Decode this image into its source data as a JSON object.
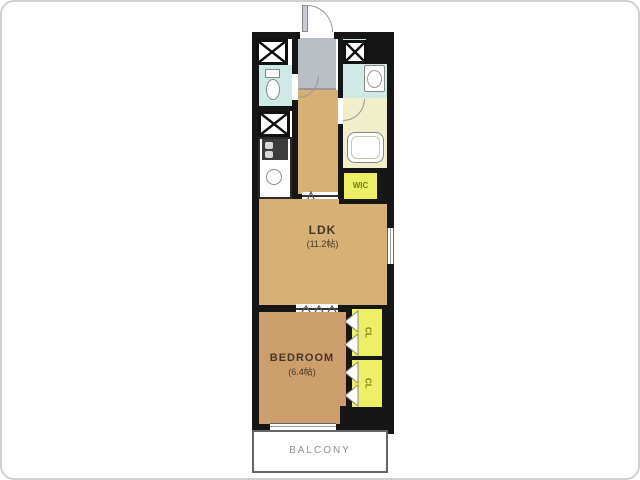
{
  "rooms": {
    "ldk": {
      "label": "LDK",
      "size": "(11.2帖)"
    },
    "bedroom": {
      "label": "BEDROOM",
      "size": "(6.4帖)"
    },
    "wic": {
      "label": "WIC"
    },
    "cl_upper": {
      "label": "CL"
    },
    "cl_lower": {
      "label": "CL"
    },
    "balcony": {
      "label": "BALCONY"
    }
  },
  "colors": {
    "wall": "#161616",
    "ldk-tan": "#d6b075",
    "bedroom-tan": "#cc9e6b",
    "water-blue": "#cfe9e6",
    "bath-cream": "#f1eecb",
    "closet-yellow": "#edef67",
    "entry-gray": "#b9bdc4",
    "label-brown": "#4a3626",
    "balcony-gray": "#8f8f8f"
  }
}
